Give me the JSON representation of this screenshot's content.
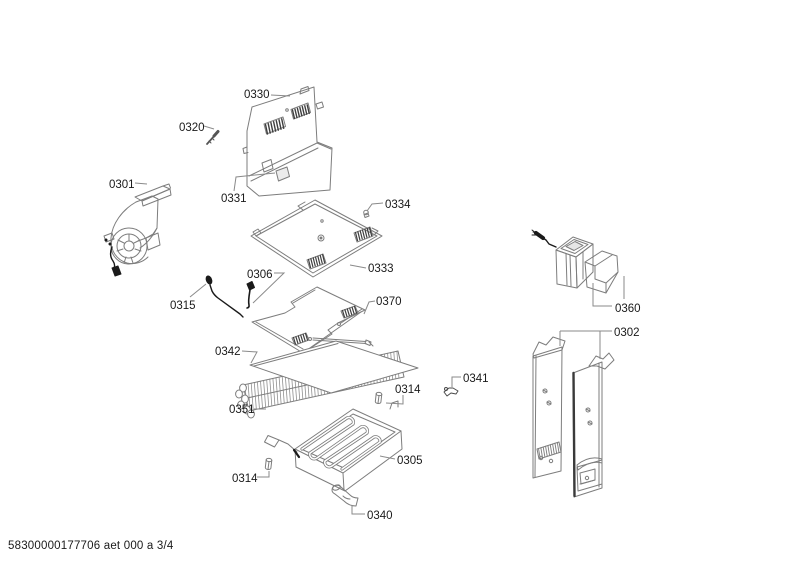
{
  "diagram": {
    "title_hint": "exploded parts diagram",
    "footer_text": "58300000177706 aet 000 a 3/4",
    "colors": {
      "line": "#7d7d7d",
      "dark": "#1a1a1a",
      "label": "#1a1a1a",
      "background": "#ffffff"
    },
    "labels": [
      {
        "text": "0330",
        "x": 244,
        "y": 98
      },
      {
        "text": "0320",
        "x": 179,
        "y": 131
      },
      {
        "text": "0301",
        "x": 109,
        "y": 188
      },
      {
        "text": "0331",
        "x": 221,
        "y": 202
      },
      {
        "text": "0334",
        "x": 385,
        "y": 208
      },
      {
        "text": "0333",
        "x": 368,
        "y": 272
      },
      {
        "text": "0306",
        "x": 247,
        "y": 278
      },
      {
        "text": "0370",
        "x": 376,
        "y": 305
      },
      {
        "text": "0315",
        "x": 170,
        "y": 309
      },
      {
        "text": "0342",
        "x": 215,
        "y": 355
      },
      {
        "text": "0314",
        "x": 395,
        "y": 393
      },
      {
        "text": "0341",
        "x": 463,
        "y": 382
      },
      {
        "text": "0351",
        "x": 229,
        "y": 413
      },
      {
        "text": "0305",
        "x": 397,
        "y": 464
      },
      {
        "text": "0314",
        "x": 232,
        "y": 482
      },
      {
        "text": "0340",
        "x": 367,
        "y": 519
      },
      {
        "text": "0360",
        "x": 615,
        "y": 312
      },
      {
        "text": "0302",
        "x": 614,
        "y": 336
      }
    ]
  }
}
